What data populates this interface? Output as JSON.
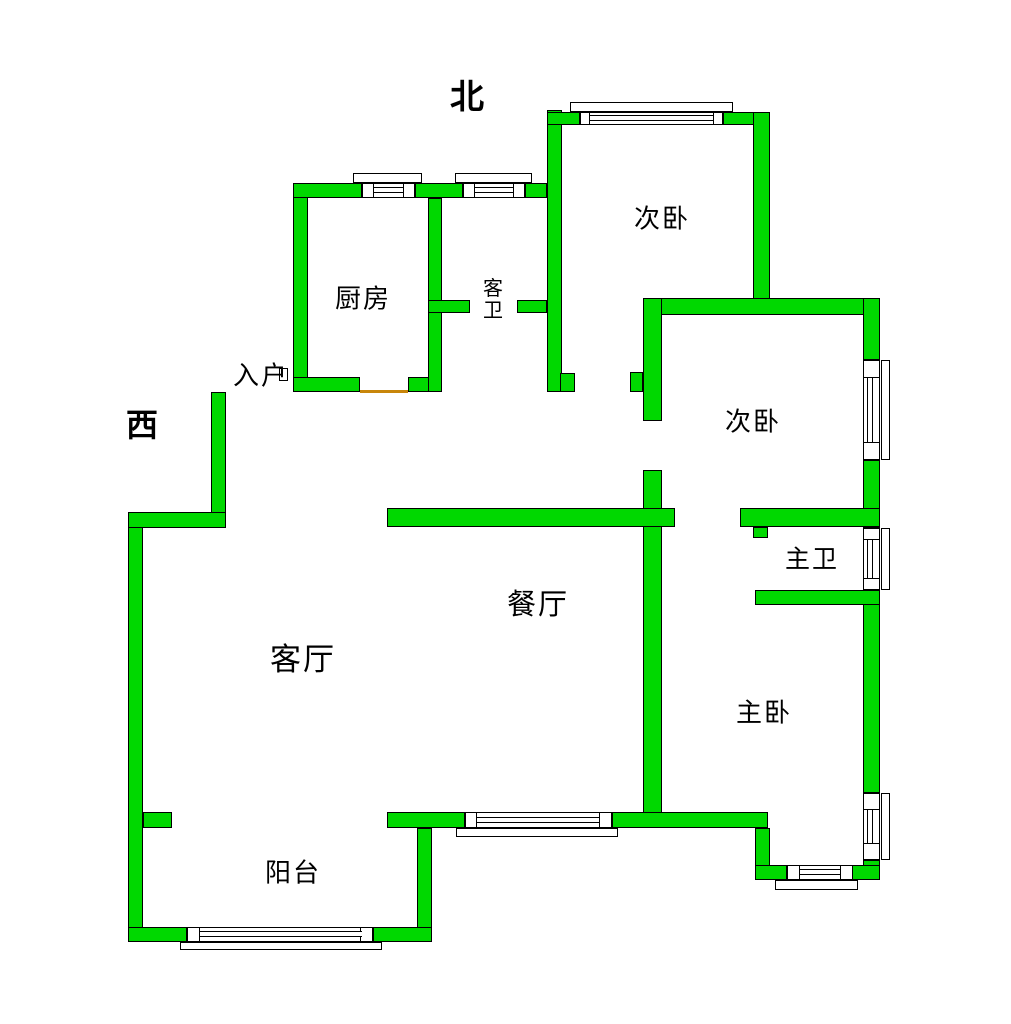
{
  "compass": {
    "north": {
      "label": "北",
      "cx": 467,
      "cy": 94,
      "size": 34
    },
    "west": {
      "label": "西",
      "cx": 142,
      "cy": 423,
      "size": 32
    }
  },
  "colors": {
    "wall_fill": "#00d800",
    "wall_border": "#000000",
    "window_fill": "#ffffff",
    "threshold": "#c8860a",
    "background": "#ffffff",
    "text": "#000000"
  },
  "rooms": [
    {
      "name": "kitchen",
      "label": "厨房",
      "cx": 363,
      "cy": 300,
      "size": 26,
      "vertical": false
    },
    {
      "name": "guest-bathroom",
      "label": "客卫",
      "cx": 493,
      "cy": 299,
      "size": 20,
      "vertical": true
    },
    {
      "name": "entry",
      "label": "入户",
      "cx": 261,
      "cy": 377,
      "size": 26,
      "vertical": false
    },
    {
      "name": "bedroom-north",
      "label": "次卧",
      "cx": 662,
      "cy": 220,
      "size": 26,
      "vertical": false
    },
    {
      "name": "bedroom-east",
      "label": "次卧",
      "cx": 753,
      "cy": 423,
      "size": 26,
      "vertical": false
    },
    {
      "name": "master-bathroom",
      "label": "主卫",
      "cx": 812,
      "cy": 559,
      "size": 25,
      "vertical": false
    },
    {
      "name": "dining-room",
      "label": "餐厅",
      "cx": 538,
      "cy": 605,
      "size": 29,
      "vertical": false
    },
    {
      "name": "living-room",
      "label": "客厅",
      "cx": 303,
      "cy": 660,
      "size": 31,
      "vertical": false
    },
    {
      "name": "master-bedroom",
      "label": "主卧",
      "cx": 764,
      "cy": 714,
      "size": 26,
      "vertical": false
    },
    {
      "name": "balcony",
      "label": "阳台",
      "cx": 293,
      "cy": 874,
      "size": 26,
      "vertical": false
    }
  ],
  "walls": [
    [
      128,
      512,
      15,
      430
    ],
    [
      143,
      812,
      29,
      16
    ],
    [
      211,
      392,
      15,
      136
    ],
    [
      128,
      512,
      98,
      16
    ],
    [
      293,
      183,
      15,
      209
    ],
    [
      293,
      183,
      69,
      15
    ],
    [
      415,
      183,
      48,
      15
    ],
    [
      525,
      183,
      22,
      15
    ],
    [
      293,
      377,
      67,
      15
    ],
    [
      408,
      377,
      34,
      15
    ],
    [
      428,
      198,
      14,
      194
    ],
    [
      428,
      300,
      42,
      13
    ],
    [
      517,
      300,
      30,
      13
    ],
    [
      547,
      110,
      15,
      282
    ],
    [
      560,
      373,
      15,
      19
    ],
    [
      547,
      112,
      33,
      13
    ],
    [
      723,
      112,
      47,
      13
    ],
    [
      753,
      112,
      17,
      190
    ],
    [
      643,
      298,
      237,
      17
    ],
    [
      643,
      298,
      19,
      123
    ],
    [
      630,
      372,
      13,
      20
    ],
    [
      643,
      470,
      19,
      343
    ],
    [
      387,
      508,
      288,
      19
    ],
    [
      863,
      298,
      17,
      62
    ],
    [
      863,
      460,
      17,
      68
    ],
    [
      863,
      590,
      17,
      203
    ],
    [
      863,
      860,
      17,
      20
    ],
    [
      740,
      508,
      140,
      19
    ],
    [
      753,
      527,
      15,
      11
    ],
    [
      755,
      590,
      125,
      15
    ],
    [
      387,
      812,
      78,
      16
    ],
    [
      612,
      812,
      156,
      16
    ],
    [
      755,
      828,
      15,
      52
    ],
    [
      755,
      865,
      32,
      15
    ],
    [
      852,
      865,
      28,
      15
    ],
    [
      417,
      828,
      15,
      114
    ],
    [
      128,
      927,
      59,
      15
    ],
    [
      373,
      927,
      59,
      15
    ]
  ],
  "windows": [
    {
      "name": "kitchen-north-window",
      "orient": "h",
      "body": [
        362,
        183,
        53,
        15
      ],
      "posts": [
        [
          362,
          183,
          12,
          15
        ],
        [
          403,
          183,
          12,
          15
        ]
      ],
      "glaze": [
        374,
        187,
        29,
        6
      ],
      "sill": [
        353,
        173,
        69,
        10
      ]
    },
    {
      "name": "guest-bath-north-window",
      "orient": "h",
      "body": [
        463,
        183,
        62,
        15
      ],
      "posts": [
        [
          463,
          183,
          12,
          15
        ],
        [
          513,
          183,
          12,
          15
        ]
      ],
      "glaze": [
        475,
        187,
        38,
        6
      ],
      "sill": [
        455,
        173,
        77,
        10
      ]
    },
    {
      "name": "bedroom-north-window",
      "orient": "h",
      "body": [
        580,
        112,
        143,
        13
      ],
      "posts": [
        [
          580,
          112,
          10,
          13
        ],
        [
          713,
          112,
          10,
          13
        ]
      ],
      "glaze": [
        590,
        115,
        123,
        6
      ],
      "sill": [
        570,
        102,
        163,
        10
      ]
    },
    {
      "name": "dining-south-window",
      "orient": "h",
      "body": [
        465,
        812,
        147,
        16
      ],
      "posts": [
        [
          465,
          812,
          12,
          16
        ],
        [
          599,
          812,
          13,
          16
        ]
      ],
      "glaze": [
        477,
        817,
        122,
        6
      ],
      "sill": [
        456,
        828,
        162,
        9
      ]
    },
    {
      "name": "master-bedroom-south-window",
      "orient": "h",
      "body": [
        787,
        865,
        66,
        15
      ],
      "posts": [
        [
          787,
          865,
          13,
          15
        ],
        [
          840,
          865,
          13,
          15
        ]
      ],
      "glaze": [
        800,
        869,
        40,
        6
      ],
      "sill": [
        775,
        880,
        83,
        10
      ]
    },
    {
      "name": "balcony-south-window",
      "orient": "h",
      "body": [
        187,
        927,
        186,
        15
      ],
      "posts": [
        [
          187,
          927,
          13,
          15
        ],
        [
          360,
          927,
          13,
          15
        ]
      ],
      "glaze": [
        200,
        931,
        162,
        6
      ],
      "sill": [
        180,
        942,
        202,
        8
      ]
    },
    {
      "name": "bedroom-east-window",
      "orient": "v",
      "body": [
        863,
        360,
        17,
        100
      ],
      "posts": [
        [
          863,
          360,
          17,
          18
        ],
        [
          863,
          442,
          17,
          18
        ]
      ],
      "glaze": [
        867,
        378,
        6,
        64
      ],
      "sill": [
        881,
        360,
        9,
        100
      ]
    },
    {
      "name": "master-bath-east-window",
      "orient": "v",
      "body": [
        863,
        528,
        17,
        62
      ],
      "posts": [
        [
          863,
          528,
          17,
          12
        ],
        [
          863,
          578,
          17,
          12
        ]
      ],
      "glaze": [
        867,
        540,
        6,
        38
      ],
      "sill": [
        881,
        528,
        9,
        62
      ]
    },
    {
      "name": "master-bedroom-east-window",
      "orient": "v",
      "body": [
        863,
        793,
        17,
        67
      ],
      "posts": [
        [
          863,
          793,
          17,
          17
        ],
        [
          863,
          843,
          17,
          17
        ]
      ],
      "glaze": [
        867,
        810,
        6,
        33
      ],
      "sill": [
        881,
        793,
        9,
        67
      ]
    }
  ],
  "thresholds": [
    {
      "name": "kitchen-door-threshold",
      "rect": [
        360,
        390,
        48,
        3
      ]
    }
  ],
  "door_posts": [
    {
      "name": "entry-door-post",
      "rect": [
        279,
        368,
        9,
        13
      ]
    }
  ]
}
